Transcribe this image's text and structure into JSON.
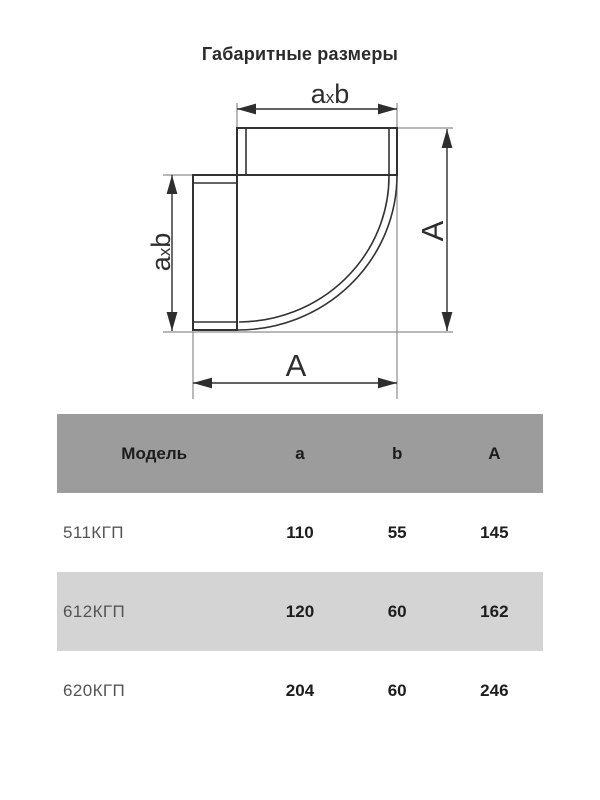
{
  "page": {
    "title": "Габаритные размеры"
  },
  "diagram": {
    "dim_top": {
      "a": "a",
      "x": "x",
      "b": "b"
    },
    "dim_side": {
      "a": "a",
      "x": "x",
      "b": "b"
    },
    "dim_right": "A",
    "dim_bottom": "A"
  },
  "table": {
    "headers": {
      "model": "Модель",
      "a": "a",
      "b": "b",
      "A": "A"
    },
    "rows": [
      {
        "model": "511КГП",
        "a": "110",
        "b": "55",
        "A": "145"
      },
      {
        "model": "612КГП",
        "a": "120",
        "b": "60",
        "A": "162"
      },
      {
        "model": "620КГП",
        "a": "204",
        "b": "60",
        "A": "246"
      }
    ]
  },
  "colors": {
    "header_bg": "#9c9c9c",
    "row_alt_bg": "#d4d4d4",
    "row_bg": "#ffffff",
    "line": "#323232",
    "extension_line": "#8d8d8d",
    "text": "#1d1d1d",
    "model_text": "#545454"
  }
}
